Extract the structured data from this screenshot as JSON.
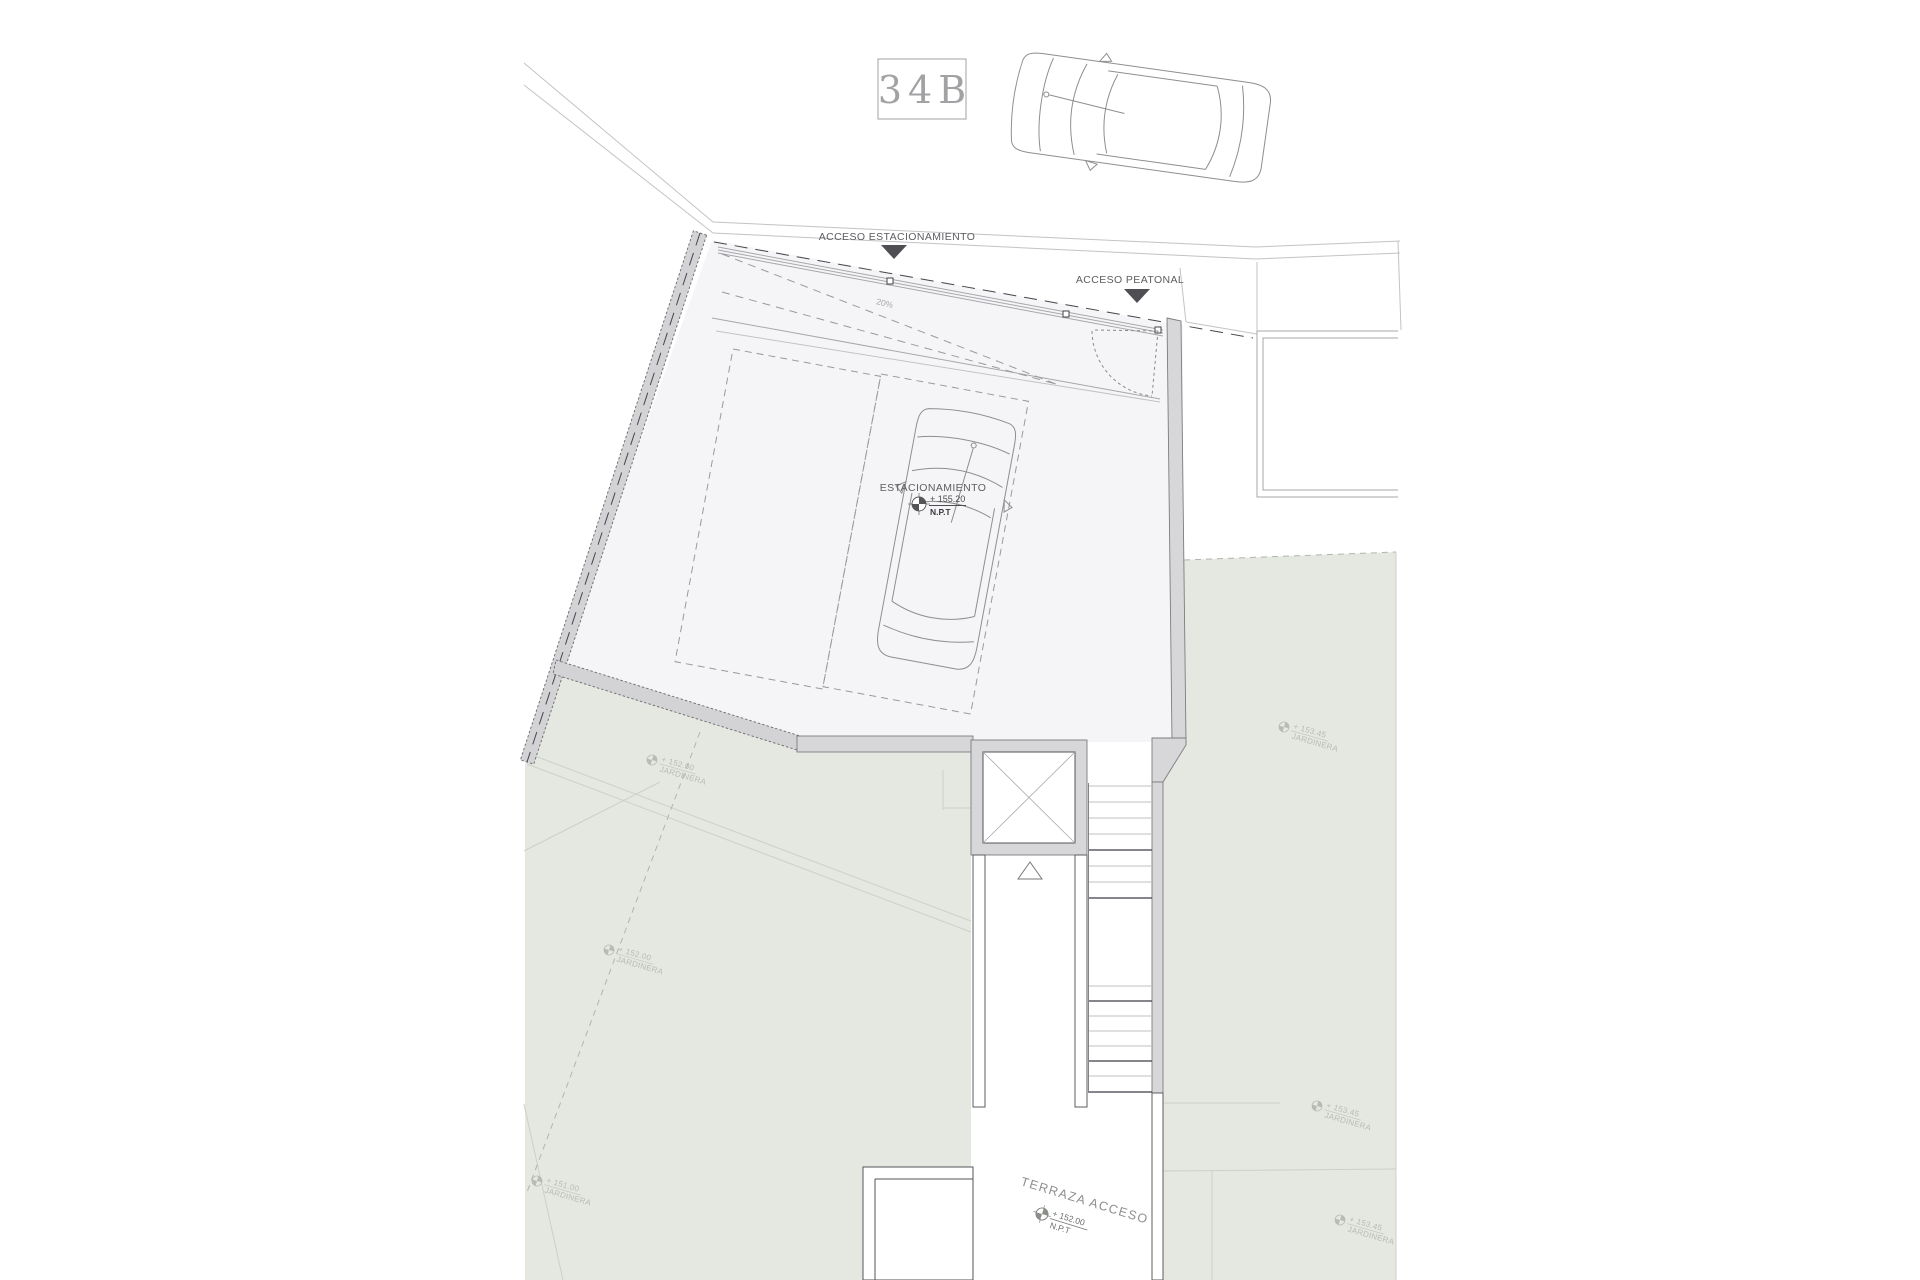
{
  "title_box": {
    "label": "34B"
  },
  "street": {
    "acceso_estacionamiento": "ACCESO ESTACIONAMIENTO",
    "acceso_peatonal": "ACCESO PEATONAL"
  },
  "parking": {
    "label": "ESTACIONAMIENTO",
    "level": "+ 155.20",
    "datum": "N.P.T",
    "ramp_slope": "20%"
  },
  "terrace": {
    "label": "TERRAZA ACCESO",
    "level": "+ 152.00",
    "datum": "N.P.T"
  },
  "planters": [
    {
      "level": "+ 152.00",
      "label": "JARDINERA"
    },
    {
      "level": "+ 152.00",
      "label": "JARDINERA"
    },
    {
      "level": "+ 151.00",
      "label": "JARDINERA"
    },
    {
      "level": "+ 153.45",
      "label": "JARDINERA"
    },
    {
      "level": "+ 153.45",
      "label": "JARDINERA"
    },
    {
      "level": "+ 153.45",
      "label": "JARDINERA"
    }
  ],
  "colors": {
    "garden_fill": "#e5e7e1",
    "wall_fill": "#d7d7da",
    "parking_fill": "#f5f5f7",
    "line_gray": "#c3c3c6",
    "label_text": "#5d5d61",
    "arrow_fill": "#4f4f53",
    "watermark": "#b7bcb1"
  }
}
